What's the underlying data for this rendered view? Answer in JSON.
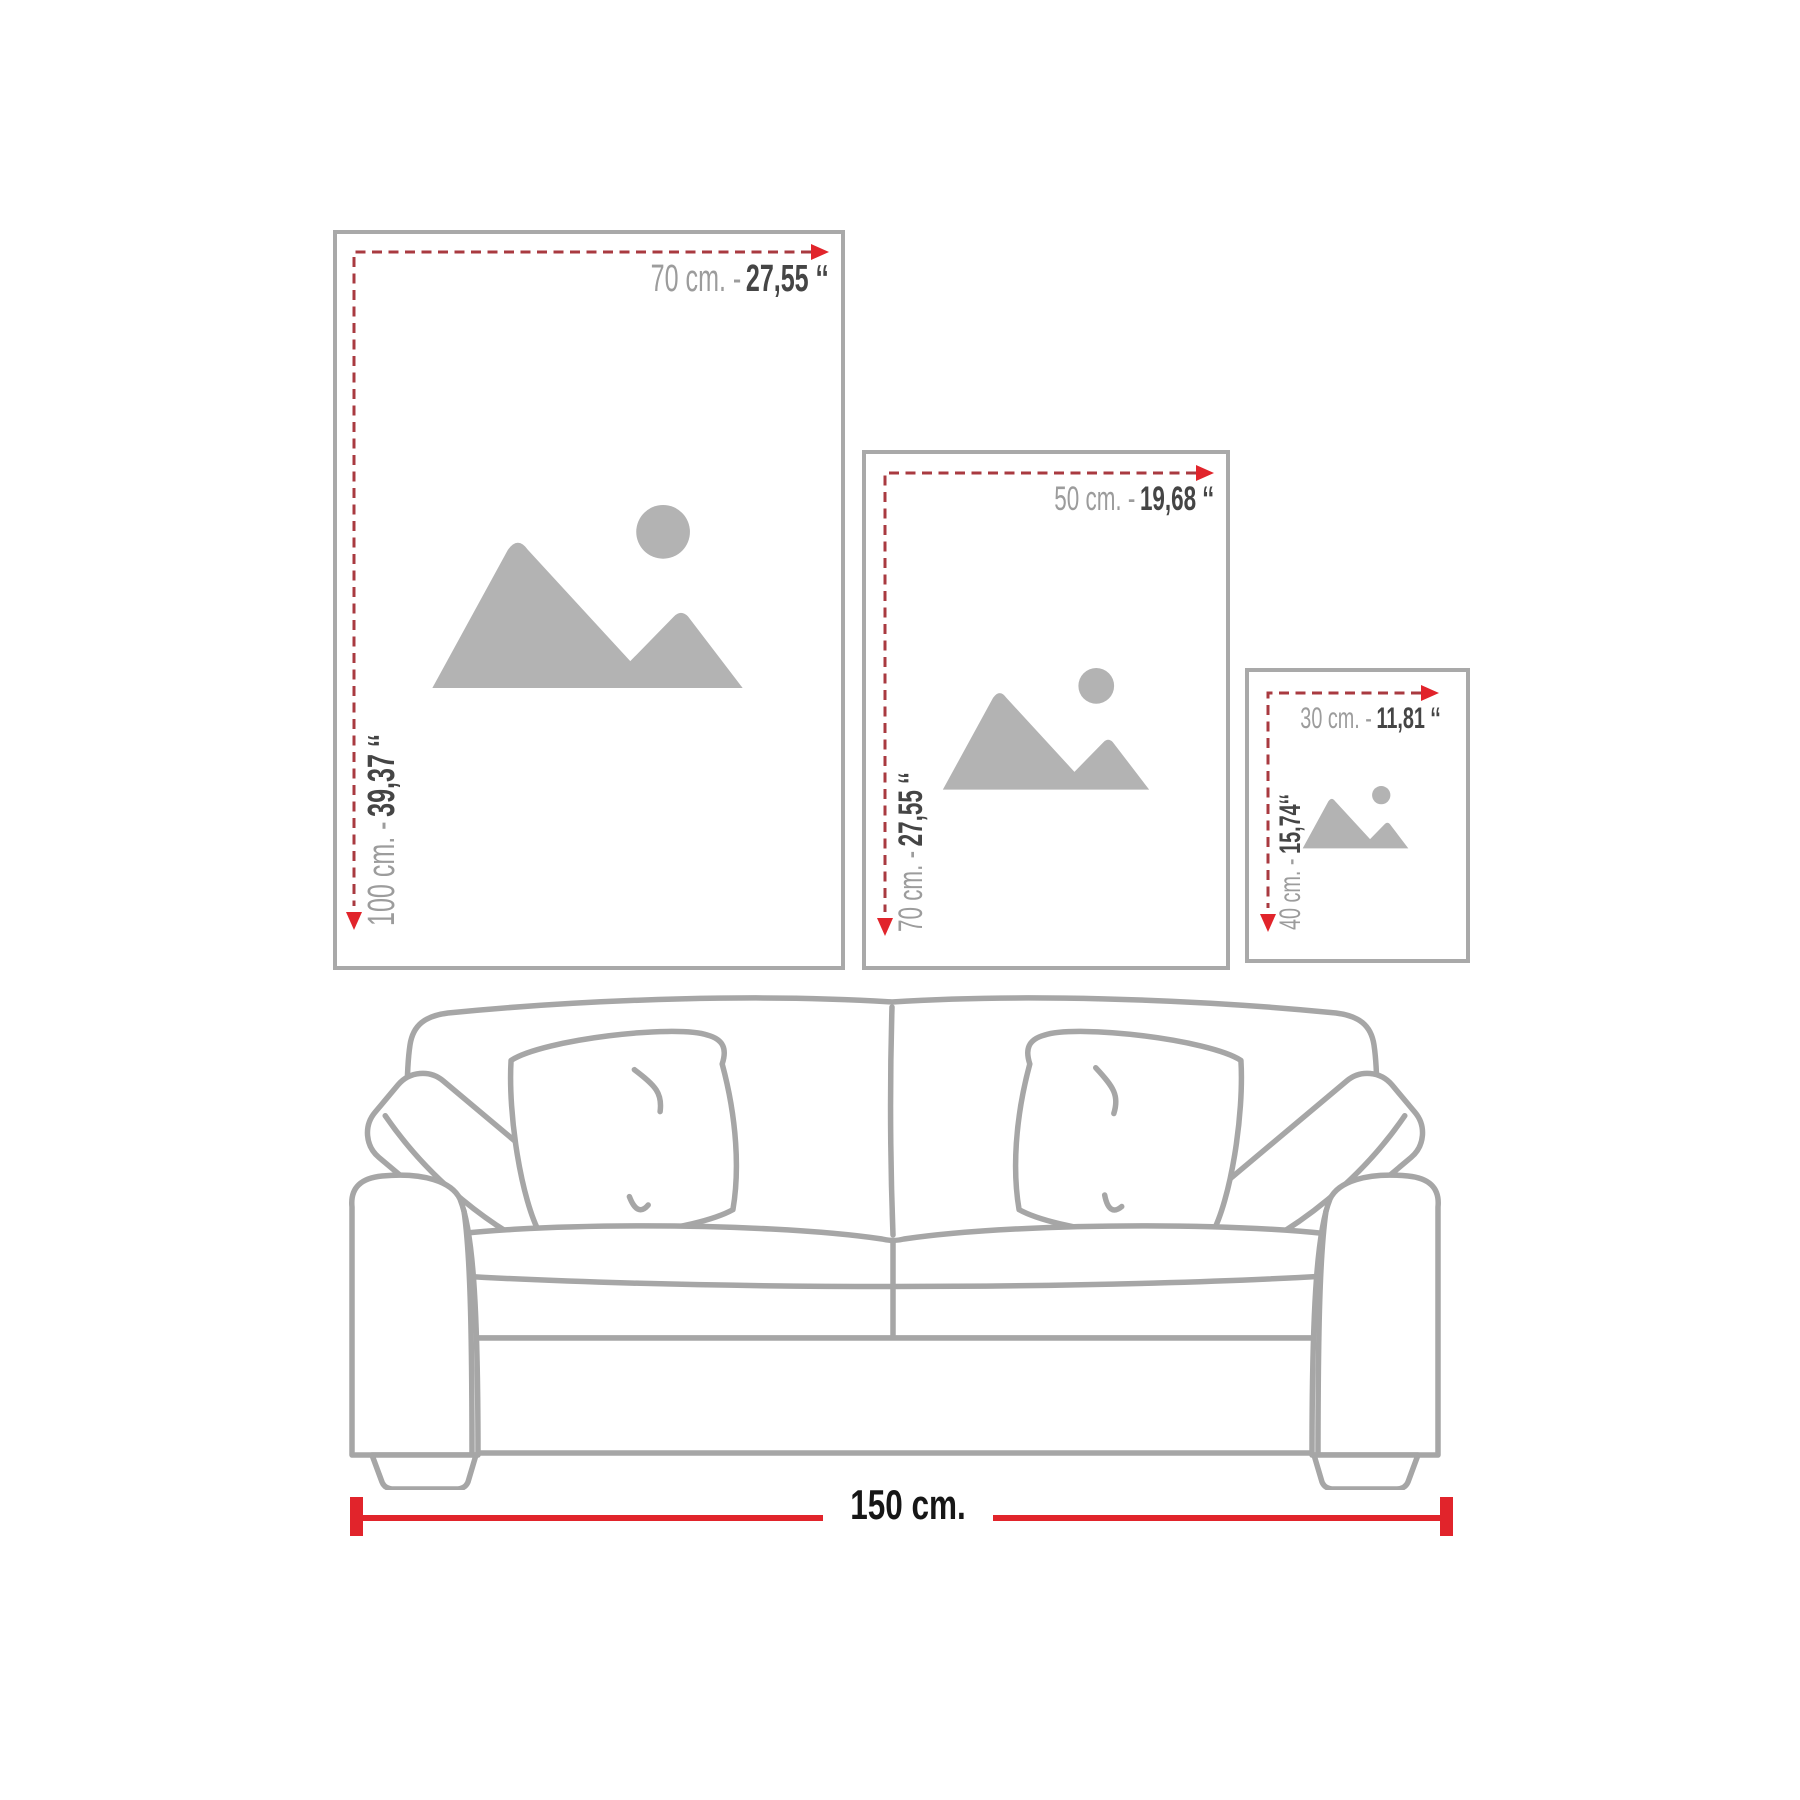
{
  "frames": [
    {
      "name": "large",
      "width_cm": "70 cm. -",
      "width_in": "27,55 ‘‘",
      "height_cm": "100 cm. -",
      "height_in": "39,37 ‘‘"
    },
    {
      "name": "medium",
      "width_cm": "50 cm. -",
      "width_in": "19,68 ‘‘",
      "height_cm": "70 cm. -",
      "height_in": "27,55 ‘‘"
    },
    {
      "name": "small",
      "width_cm": "30 cm. -",
      "width_in": "11,81 ‘‘",
      "height_cm": "40 cm. -",
      "height_in": "15,74‘‘"
    }
  ],
  "sofa": {
    "width_label": "150 cm."
  },
  "icons": {
    "image_placeholder": "gray mountains with sun",
    "arrow_right": "solid red triangle",
    "arrow_down": "solid red triangle"
  },
  "colors": {
    "frame_border": "#a9a9a9",
    "dash_red": "#a93a40",
    "accent_red": "#e1242b",
    "label_gray": "#9c9c9c",
    "label_dark": "#454545",
    "ruler_text": "#161616",
    "placeholder_gray": "#b3b3b3",
    "sofa_outline": "#a6a6a6",
    "background": "#ffffff"
  }
}
